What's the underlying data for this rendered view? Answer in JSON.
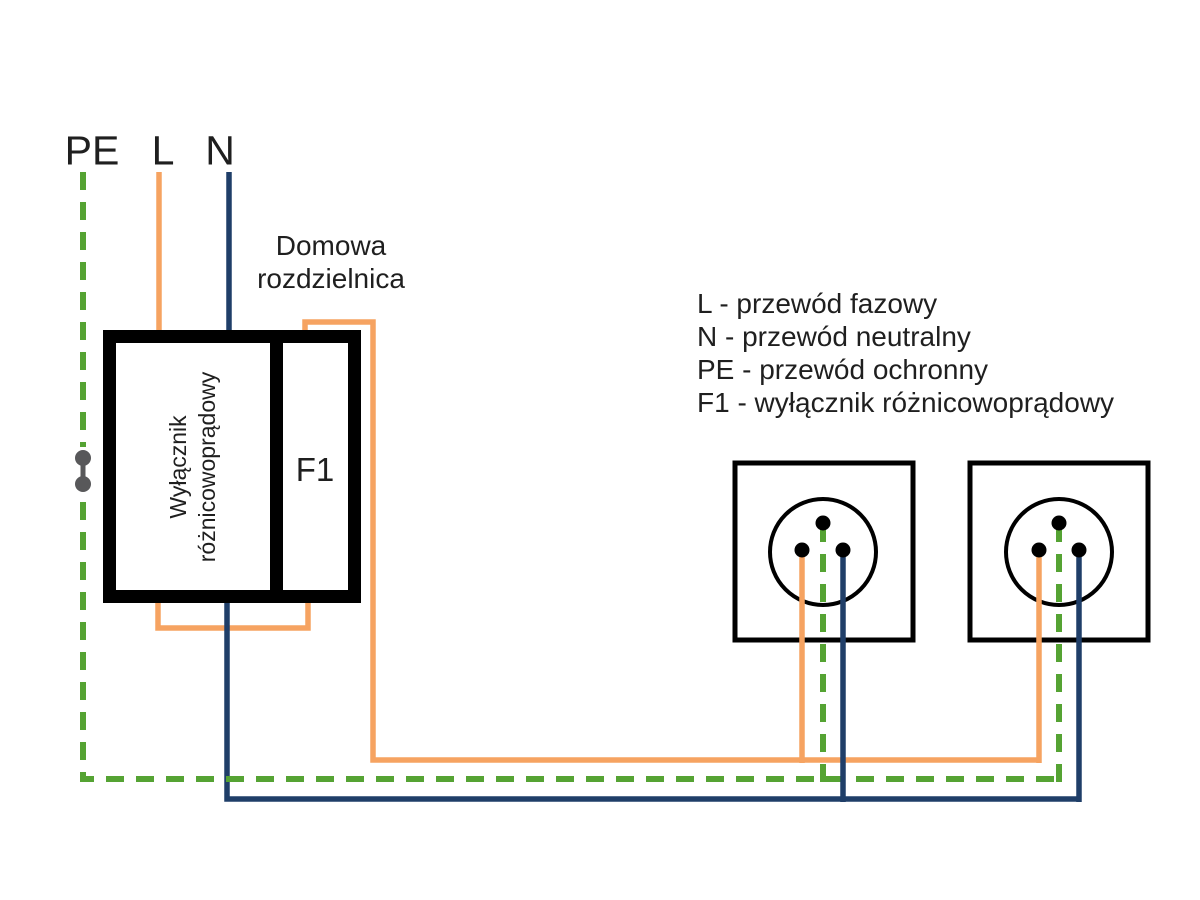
{
  "source": {
    "pe": "PE",
    "l": "L",
    "n": "N"
  },
  "panel": {
    "title_lines": [
      "Domowa",
      "rozdzielnica"
    ],
    "device_lines": [
      "Wyłącznik",
      "różnicowoprądowy"
    ],
    "breaker_label": "F1"
  },
  "legend": {
    "items": [
      "L - przewód fazowy",
      "N - przewód neutralny",
      "PE - przewód ochronny",
      "F1 - wyłącznik różnicowoprądowy"
    ]
  },
  "colors": {
    "l_phase": "#f6a361",
    "n_neutral": "#1f3e68",
    "pe_protective": "#55a333",
    "connector_gray": "#58585a",
    "outline_black": "#000000"
  }
}
